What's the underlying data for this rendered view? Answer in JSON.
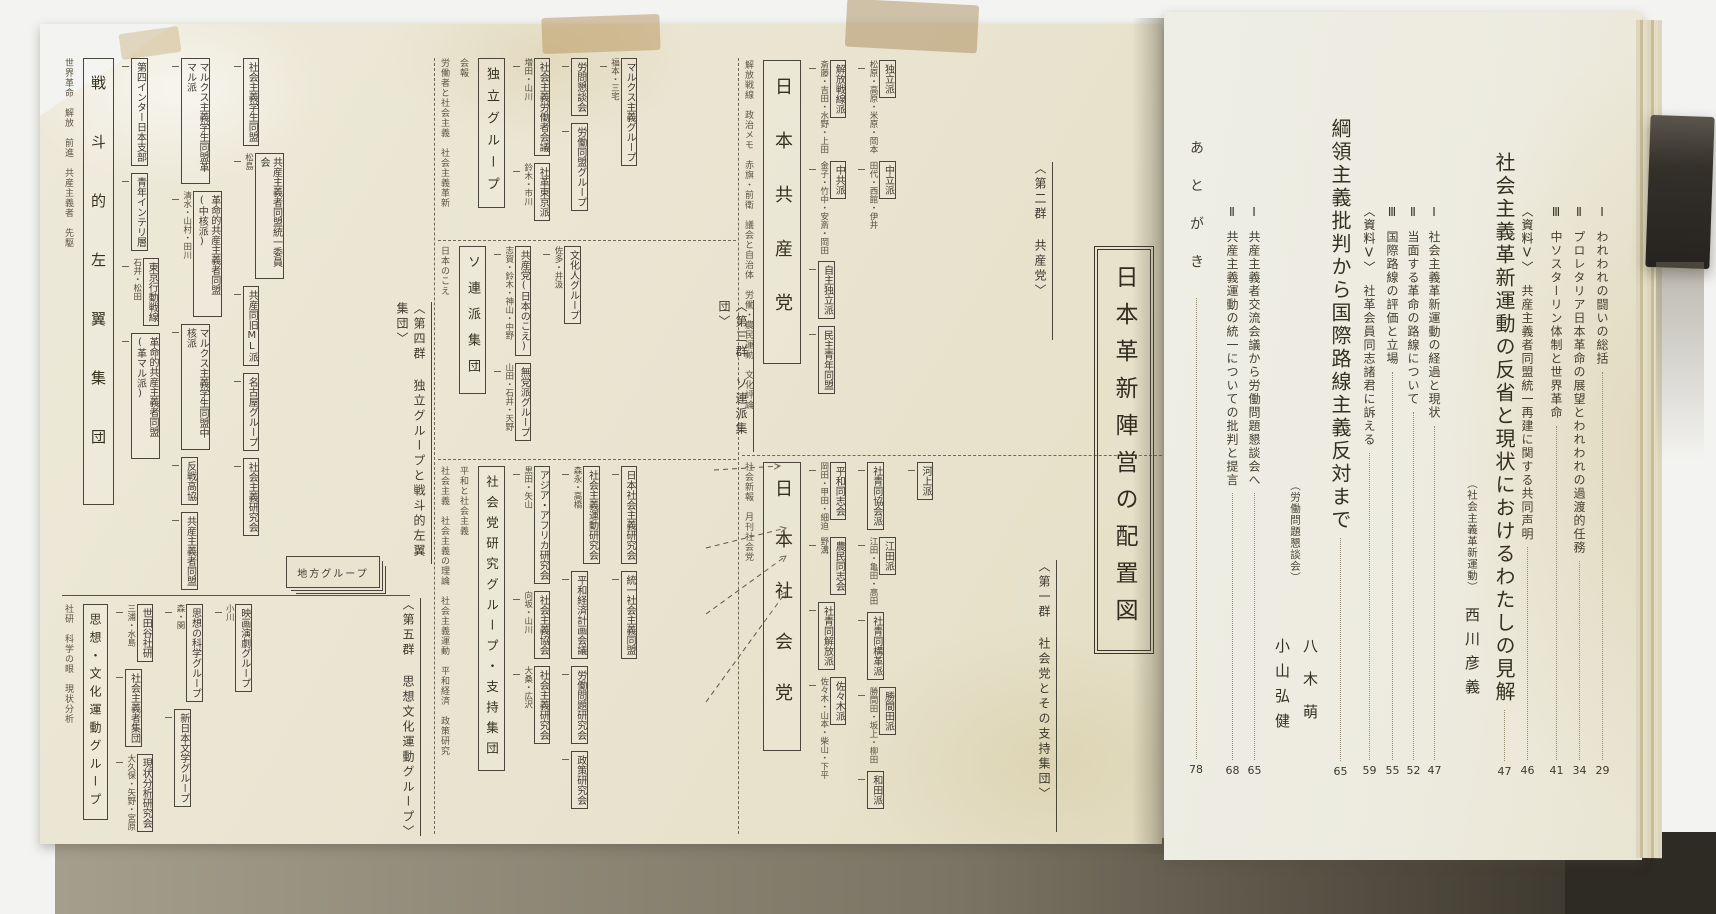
{
  "colors": {
    "background": "#f3f3f1",
    "foldout_paper": "#e9e4d0",
    "toc_paper": "#edebdf",
    "ink": "#3d392e",
    "clip": "#2b2722"
  },
  "left_page": {
    "chart_title": "日本革新陣営の配置図",
    "stack_box": "地方グループ",
    "sections": {
      "socialist": {
        "label": "〈第一群 社会党とその支持集団〉",
        "main": "日本社会党",
        "pubs": [
          "社会新報",
          "月刊社会党"
        ],
        "boxes": [
          {
            "label": "平和同志会",
            "names": "岡田・甲田・細迫"
          },
          {
            "label": "農民同志会",
            "names": "野溝"
          },
          {
            "label": "社青同解放派",
            "names": ""
          },
          {
            "label": "佐々木派",
            "names": "佐々木・山本・柴山・下平"
          },
          {
            "label": "社青同協会派",
            "names": ""
          },
          {
            "label": "江田派",
            "names": "江田・亀田・高田"
          },
          {
            "label": "社青同構革派",
            "names": ""
          },
          {
            "label": "勝間田派",
            "names": "勝間田・坂上・柳田"
          },
          {
            "label": "和田派",
            "names": ""
          },
          {
            "label": "河上派",
            "names": ""
          }
        ]
      },
      "communist": {
        "label": "〈第二群 共産党〉",
        "main": "日本共産党",
        "pubs": [
          "解放戦線",
          "政治メモ",
          "赤旗・前衛",
          "議会と自治体",
          "労働・農民運動",
          "文化評論"
        ],
        "boxes": [
          {
            "label": "解放戦線派",
            "names": "斎藤・吉田・水野・上田"
          },
          {
            "label": "中共派",
            "names": "金子・竹中・安斎・岡田"
          },
          {
            "label": "自主独立派",
            "names": ""
          },
          {
            "label": "民主青年同盟",
            "names": ""
          },
          {
            "label": "独立派",
            "names": "松原・高原・米原・岡本"
          },
          {
            "label": "中立派",
            "names": "田代・西館・伊井"
          }
        ]
      },
      "soviet": {
        "label": "〈第三群 ソ連派集団〉",
        "main": "ソ連派集団",
        "pubs": [
          "日本のこえ"
        ],
        "boxes": [
          {
            "label": "共産党(日本のこえ)",
            "names": "志賀・鈴木・神山・中野"
          },
          {
            "label": "無党派グループ",
            "names": "山田・石井・天野"
          },
          {
            "label": "文化人グループ",
            "names": "佐多・井汲"
          }
        ]
      },
      "indep": {
        "main": "独立グループ",
        "pubs": [
          "労働者と社会主義",
          "社会主義革新",
          "会報"
        ],
        "boxes": [
          {
            "label": "社会主義労働者会議",
            "names": "増田・山川"
          },
          {
            "label": "社革東京派",
            "names": "鈴木・市川"
          },
          {
            "label": "労問懇談会",
            "names": ""
          },
          {
            "label": "労働同盟グループ",
            "names": ""
          },
          {
            "label": "マルクス主義グループ",
            "names": "福本・三宅"
          }
        ]
      },
      "kenkyu": {
        "main": "社会党研究グループ・支持集団",
        "pubs": [
          "社会主義",
          "社会主義の理論",
          "社会主義運動",
          "平和経済",
          "政策研究",
          "平和と社会主義"
        ],
        "boxes": [
          {
            "label": "アジア・アフリカ研究会",
            "names": "黒田・矢山"
          },
          {
            "label": "社会主義協会",
            "names": "向坂・山川"
          },
          {
            "label": "社会主義研究会",
            "names": "大桑・広沢"
          },
          {
            "label": "社会主義運動研究会",
            "names": "森永・高橋"
          },
          {
            "label": "平和経済計画会議",
            "names": ""
          },
          {
            "label": "労働問題研究会",
            "names": ""
          },
          {
            "label": "政策研究会",
            "names": ""
          },
          {
            "label": "日本社会主義研究会",
            "names": ""
          },
          {
            "label": "統一社会主義同盟",
            "names": ""
          }
        ]
      },
      "leftwing": {
        "label": "〈第四群 独立グループと戦斗的左翼集団〉",
        "main": "戦斗的左翼集団",
        "pubs": [
          "世界革命",
          "解放",
          "前進",
          "共産主義者",
          "先駆"
        ],
        "boxes": [
          {
            "label": "第四インター日本支部",
            "names": ""
          },
          {
            "label": "青年インテリ層",
            "names": ""
          },
          {
            "label": "東京行動戦線",
            "names": "石井・松田"
          },
          {
            "label": "革命的共産主義者同盟(革マル派)",
            "names": ""
          },
          {
            "label": "マルクス主義学生同盟革マル派",
            "names": ""
          },
          {
            "label": "革命的共産主義者同盟(中核派)",
            "names": "清水・山村・田川"
          },
          {
            "label": "マルクス主義学生同盟中核派",
            "names": ""
          },
          {
            "label": "反戦高協",
            "names": ""
          },
          {
            "label": "共産主義者同盟",
            "names": ""
          },
          {
            "label": "社会主義学生同盟",
            "names": ""
          },
          {
            "label": "共産主義者同盟統一委員会",
            "names": "松島"
          },
          {
            "label": "共産同旧ML派",
            "names": ""
          },
          {
            "label": "名古屋グループ",
            "names": ""
          },
          {
            "label": "社会主義研究会",
            "names": ""
          }
        ]
      },
      "culture": {
        "label": "〈第五群 思想文化運動グループ〉",
        "main": "思想・文化運動グループ",
        "pubs": [
          "社研",
          "科学の眼",
          "現状分析"
        ],
        "boxes": [
          {
            "label": "世田谷社研",
            "names": "三浦・水島"
          },
          {
            "label": "社会主義者集団",
            "names": ""
          },
          {
            "label": "現状分析研究会",
            "names": "大久保・矢野・宮原"
          },
          {
            "label": "思想の科学グループ",
            "names": "森・関"
          },
          {
            "label": "新日本文学グループ",
            "names": ""
          },
          {
            "label": "映画演劇グループ",
            "names": "小川"
          }
        ]
      }
    }
  },
  "right_page": {
    "prev_sections": [
      {
        "label": "Ⅰ",
        "text": "われわれの闘いの総括",
        "page": "29"
      },
      {
        "label": "Ⅱ",
        "text": "プロレタリア日本革命の展望とわれわれの過渡的任務",
        "page": "34"
      },
      {
        "label": "Ⅲ",
        "text": "中ソスターリン体制と世界革命",
        "page": "41"
      },
      {
        "label": "〈資料Ⅴ〉",
        "text": "共産主義者同盟統一再建に関する共同声明",
        "page": "46"
      }
    ],
    "article1": {
      "title": "社会主義革新運動の反省と現状におけるわたしの見解",
      "subtitle": "（社会主義革新運動）",
      "author": "西川彦義",
      "page": "47",
      "sections": [
        {
          "label": "Ⅰ",
          "text": "社会主義革新運動の経過と現状",
          "page": "47"
        },
        {
          "label": "Ⅱ",
          "text": "当面する革命の路線について",
          "page": "52"
        },
        {
          "label": "Ⅲ",
          "text": "国際路線の評価と立場",
          "page": "55"
        },
        {
          "label": "〈資料Ⅴ〉",
          "text": "社革会員同志諸君に訴える",
          "page": "59"
        }
      ]
    },
    "article2": {
      "title": "綱領主義批判から国際路線主義反対まで",
      "subtitle": "（労働問題懇談会）",
      "author1": "八木萌",
      "author2": "小山弘健",
      "page": "65",
      "sections": [
        {
          "label": "Ⅰ",
          "text": "共産主義者交流会議から労働問題懇談会へ",
          "page": "65"
        },
        {
          "label": "Ⅱ",
          "text": "共産主義運動の統一についての批判と提言",
          "page": "68"
        }
      ]
    },
    "afterword": {
      "text": "あとがき",
      "page": "78"
    }
  }
}
